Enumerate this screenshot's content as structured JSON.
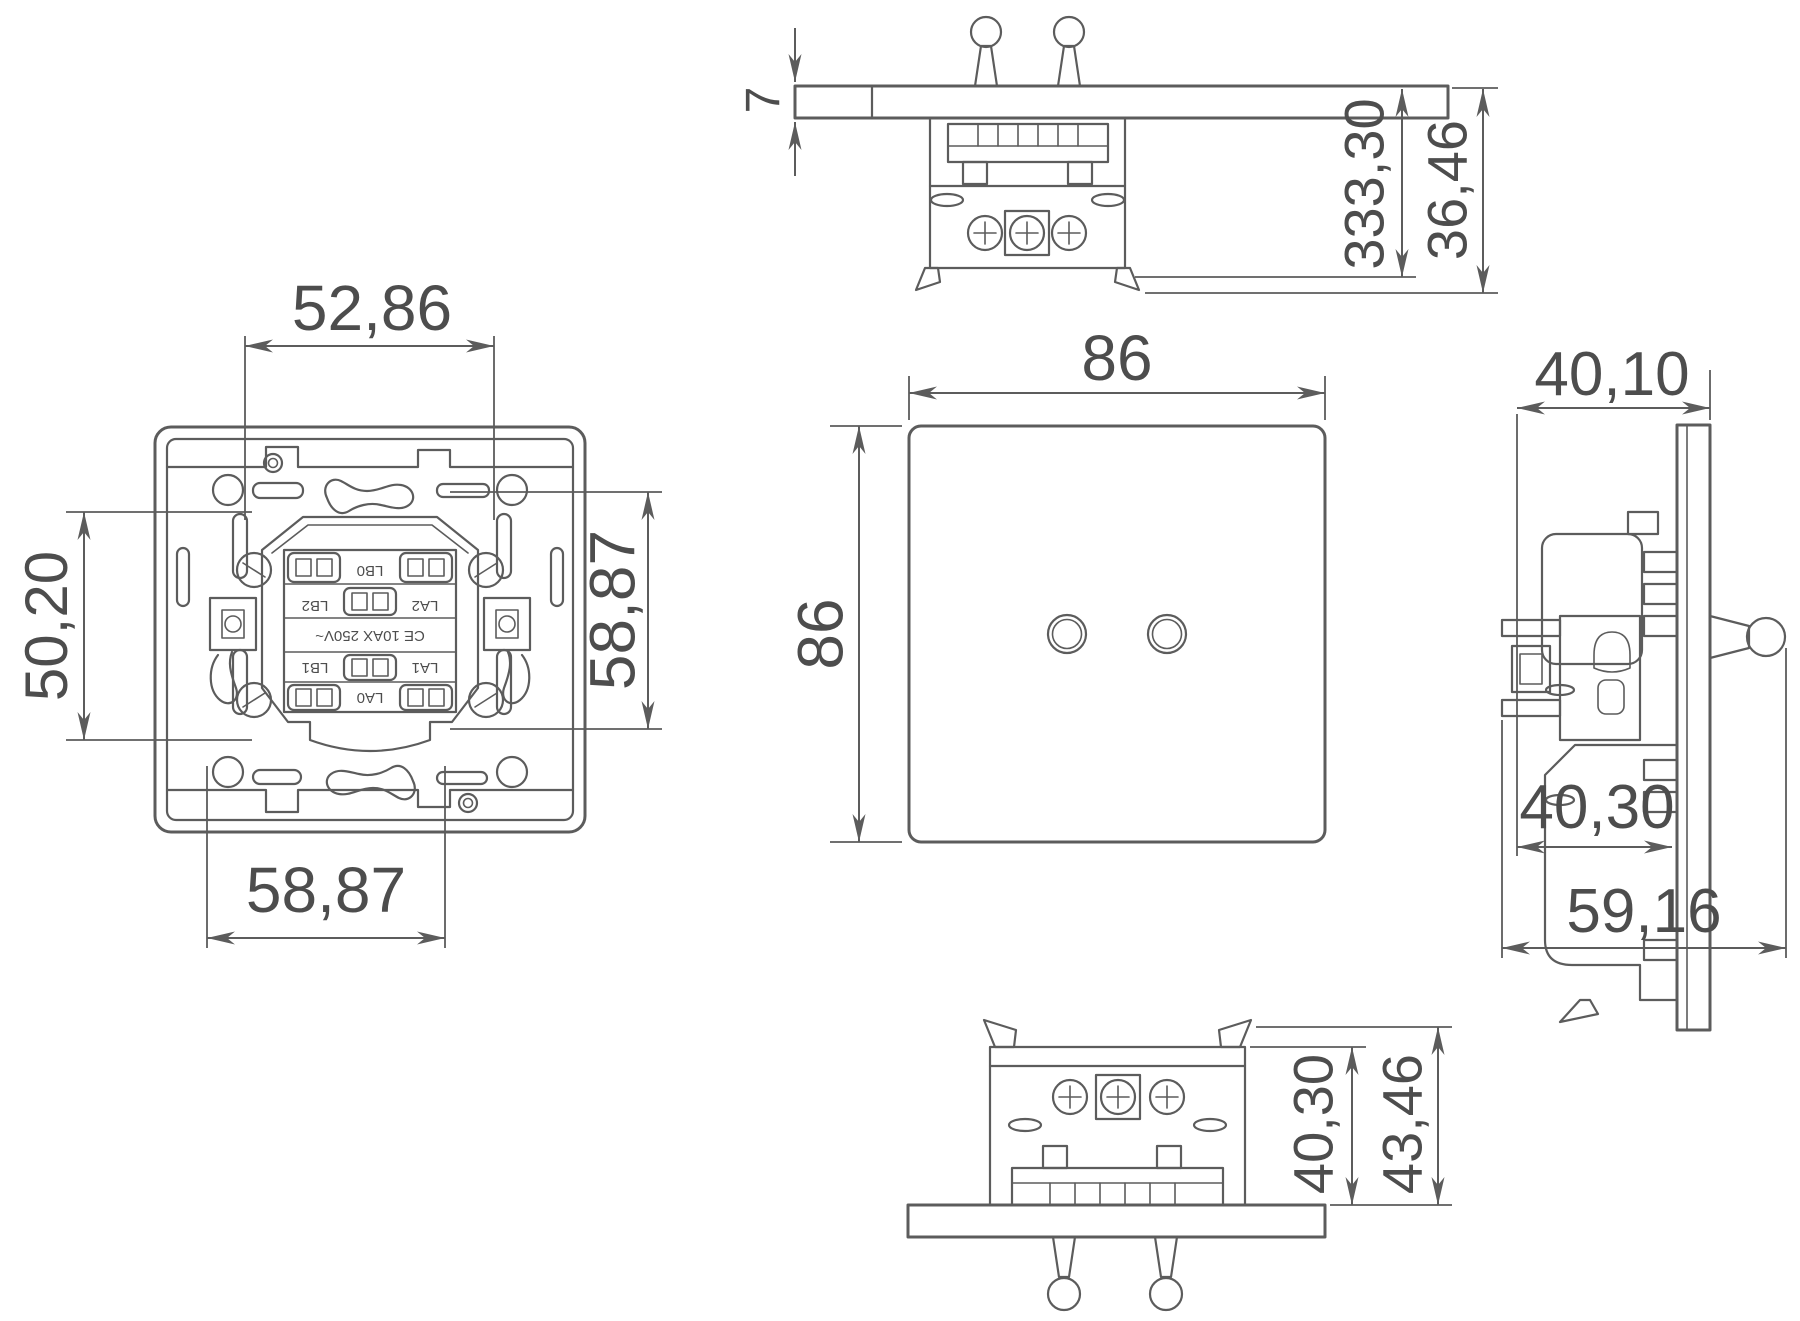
{
  "drawing": {
    "kind": "technical dimension drawing of a two-toggle wall switch",
    "background": "#ffffff",
    "ink": "#5c5c5c",
    "text_color": "#4d4d4d"
  },
  "views": {
    "back": {
      "name": "back-view",
      "dims": {
        "top": "52,86",
        "left": "50,20",
        "right": "58,87",
        "bottom": "58,87"
      },
      "terminals": {
        "top_center": "LB0",
        "mid_left": "LB2",
        "mid_right": "LA2",
        "low_left": "LB1",
        "low_right": "LA1",
        "bottom_center": "LA0"
      },
      "rating": "CE 10AX 250V~"
    },
    "top": {
      "name": "top-view",
      "dims": {
        "thickness": "7",
        "depth_inner": "333,30",
        "depth_outer": "36,46"
      }
    },
    "front": {
      "name": "front-view",
      "dims": {
        "width": "86",
        "height": "86"
      }
    },
    "side": {
      "name": "side-view",
      "dims": {
        "front": "40,10",
        "body": "40,30",
        "total": "59,16"
      }
    },
    "bottom": {
      "name": "bottom-view",
      "dims": {
        "body": "40,30",
        "total": "43,46"
      }
    }
  }
}
